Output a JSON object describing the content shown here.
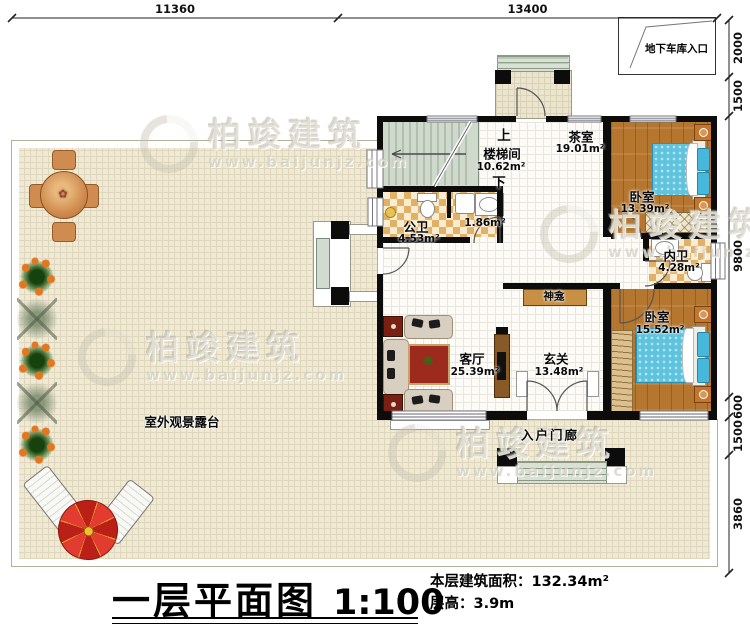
{
  "plan": {
    "dimensions_top": [
      "11360",
      "13400"
    ],
    "dimensions_right": [
      "2000",
      "1500",
      "9800",
      "600",
      "1500",
      "3860"
    ],
    "garage_entrance_label": "地下车库入口",
    "terrace_label": "室外观景露台",
    "entry_porch_label": "入户门廊",
    "shrine_label": "神龛",
    "stairwell": {
      "up": "上",
      "name": "楼梯间",
      "area": "10.62m²",
      "down": "下"
    },
    "rooms": {
      "tea_room": {
        "name": "茶室",
        "area": "19.01m²"
      },
      "bedroom_top": {
        "name": "卧室",
        "area": "13.39m²"
      },
      "public_bath": {
        "name": "公卫",
        "area": "4.53m²"
      },
      "wash_area": {
        "area": "1.86m²"
      },
      "ensuite_bath": {
        "name": "内卫",
        "area": "4.28m²"
      },
      "living_room": {
        "name": "客厅",
        "area": "25.39m²"
      },
      "foyer": {
        "name": "玄关",
        "area": "13.48m²"
      },
      "bedroom_bottom": {
        "name": "卧室",
        "area": "15.52m²"
      }
    }
  },
  "title_block": {
    "title": "一层平面图",
    "scale": "1:100",
    "area_label": "本层建筑面积：",
    "area_value": "132.34m²",
    "height_label": "层高：",
    "height_value": "3.9m"
  },
  "watermark": {
    "brand": "柏竣建筑",
    "url": "www.baijunjz.com"
  }
}
